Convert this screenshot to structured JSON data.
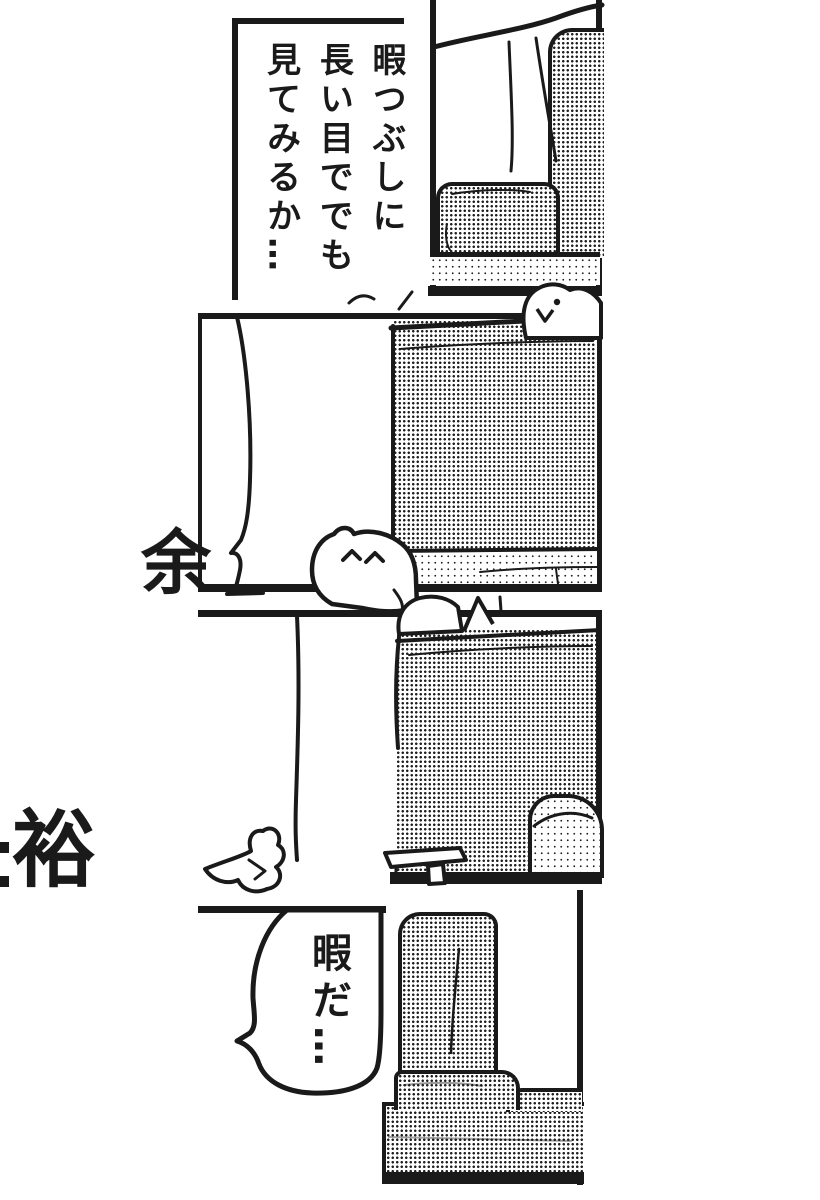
{
  "page": {
    "type": "manga-page",
    "ink_color": "#1a1a1a",
    "paper_color": "#ffffff",
    "margin_text": {
      "kanji_upper": "余",
      "kanji_lower": "裕"
    },
    "panels": [
      {
        "name": "panel-1-top",
        "dialogue": "暇つぶしに長い目ででも見てみるか…",
        "dialogue_columns": [
          "暇つぶしに",
          "長い目ででも",
          "見てみるか…"
        ],
        "scene": "sofa corner with curtain backdrop"
      },
      {
        "name": "panel-2",
        "dialogue": "",
        "scene": "cat head peeking over sofa back, empty speech bubble at left, cat face at bottom"
      },
      {
        "name": "panel-3",
        "dialogue": "",
        "scene": "cat lying behind sofa back, side table and armrest, empty bubble at left"
      },
      {
        "name": "panel-4-bottom",
        "dialogue": "暇だ…",
        "dialogue_columns": [
          "暇だ…"
        ],
        "scene": "empty sofa seat"
      }
    ]
  }
}
